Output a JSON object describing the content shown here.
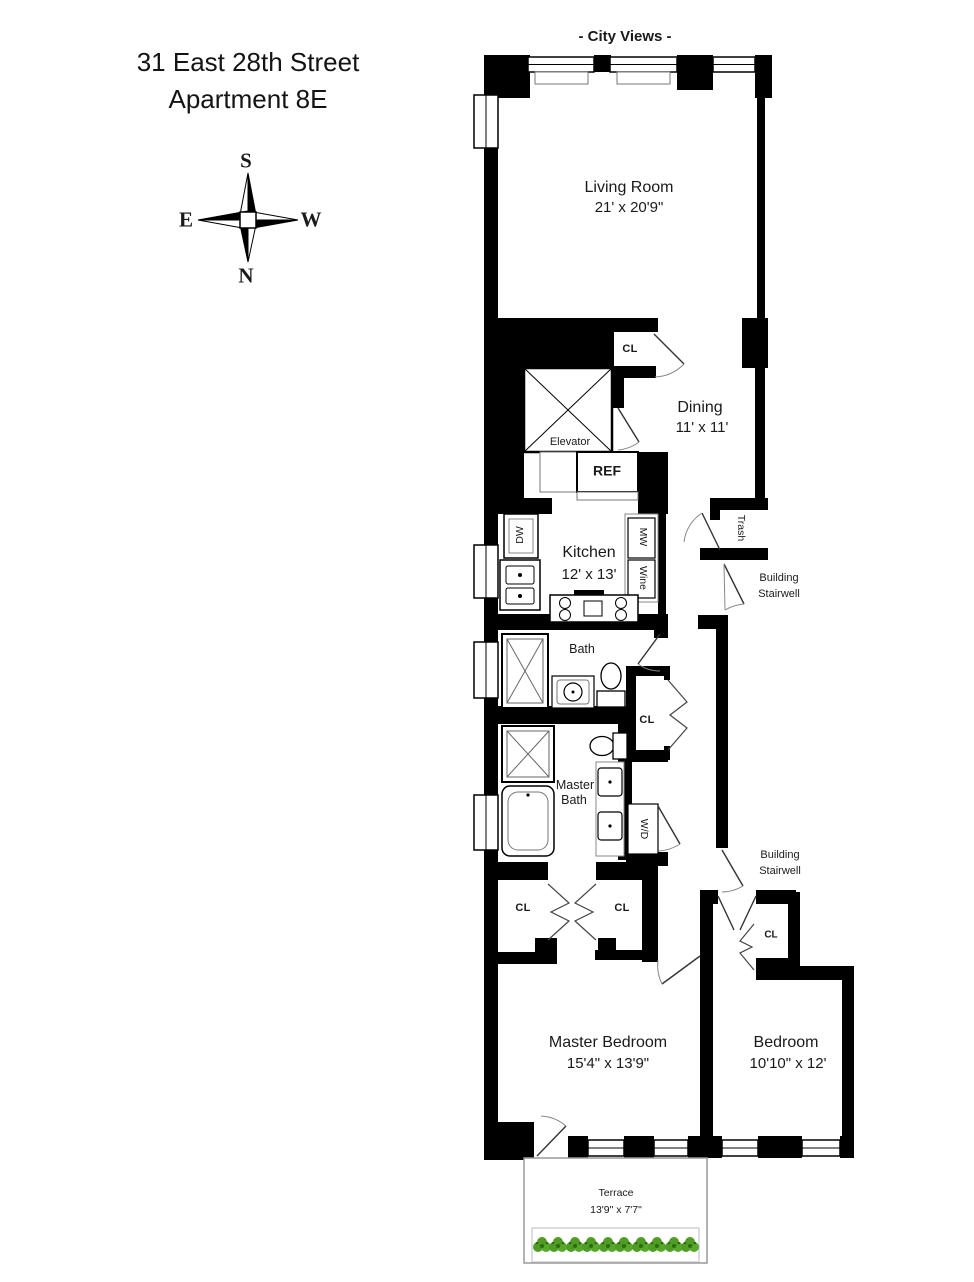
{
  "header": {
    "title_line1": "31 East 28th Street",
    "title_line2": "Apartment 8E",
    "city_views": "- City Views -"
  },
  "compass": {
    "south": "S",
    "north": "N",
    "east": "E",
    "west": "W"
  },
  "rooms": {
    "living_room": {
      "name": "Living Room",
      "dims": "21' x 20'9\""
    },
    "dining": {
      "name": "Dining",
      "dims": "11' x 11'"
    },
    "kitchen": {
      "name": "Kitchen",
      "dims": "12' x 13'"
    },
    "bath": {
      "name": "Bath"
    },
    "master_bath": {
      "line1": "Master",
      "line2": "Bath"
    },
    "master_bedroom": {
      "name": "Master Bedroom",
      "dims": "15'4\" x 13'9\""
    },
    "bedroom": {
      "name": "Bedroom",
      "dims": "10'10\" x 12'"
    },
    "terrace": {
      "name": "Terrace",
      "dims": "13'9\" x 7'7\""
    }
  },
  "fixtures": {
    "elevator": "Elevator",
    "refrigerator": "REF",
    "trash": "Trash",
    "dishwasher": "DW",
    "microwave": "MW",
    "wine": "Wine",
    "washer_dryer": "W/D"
  },
  "closets": {
    "dining": "CL",
    "hall": "CL",
    "master_left": "CL",
    "master_right": "CL",
    "bedroom": "CL"
  },
  "annotations": {
    "stairwell_upper": {
      "line1": "Building",
      "line2": "Stairwell"
    },
    "stairwell_lower": {
      "line1": "Building",
      "line2": "Stairwell"
    }
  },
  "colors": {
    "wall": "#000000",
    "plant_green": "#54a02c",
    "plant_dark": "#2e6b12",
    "terrace_border": "#999999"
  }
}
